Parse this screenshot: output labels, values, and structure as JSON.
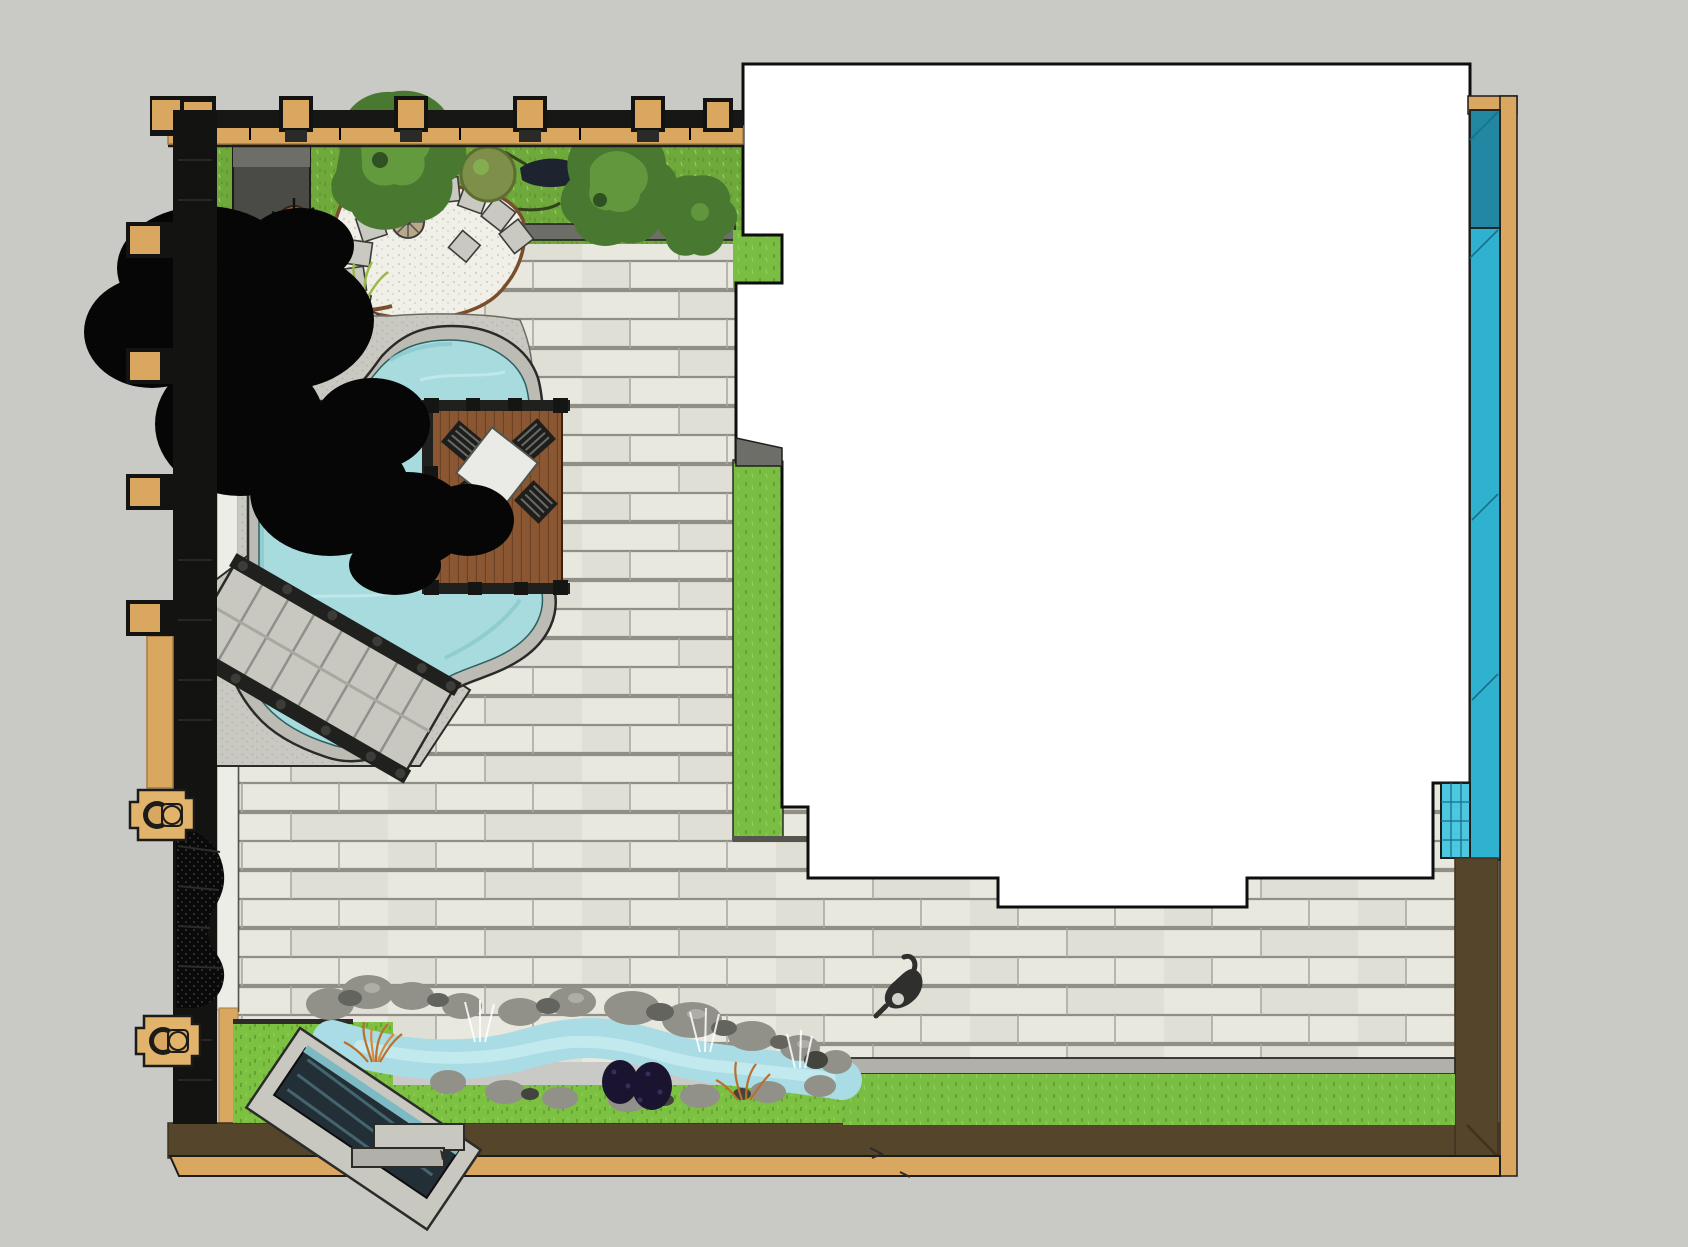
{
  "canvas": {
    "width": 1688,
    "height": 1247
  },
  "scene": {
    "type": "landscape-design-plan-top-view",
    "elements": [
      "house-footprint",
      "paver-patio",
      "kidney-pool",
      "pool-coping",
      "wood-deck",
      "patio-table",
      "patio-chairs",
      "spa-stairs",
      "garden-lawn",
      "gravel-garden",
      "stepping-stones",
      "round-shrub",
      "potted-plants",
      "conifer-trees",
      "shade-tree-canopy",
      "water-wall-strip",
      "tile-spa-block",
      "stream-water-feature",
      "waterfall-spillway",
      "stream-rocks",
      "fountain-jets",
      "ornamental-bushes",
      "perimeter-fence",
      "fence-posts",
      "hose-bib-boxes",
      "privacy-mesh",
      "soil-bed",
      "timber-border",
      "lawn-strips",
      "person-figure"
    ]
  },
  "palette": {
    "bg": "#c9c9c6",
    "paver": "#e9e8df",
    "paverAlt": "#e0dfd6",
    "paverLine": "#8f8f87",
    "paverLine2": "#aaaaa2",
    "curb": "#edede7",
    "lawnTop": "#6fa93c",
    "lawnBright": "#79bd42",
    "lawnBottom": "#7cc141",
    "grassDark": "#578f2b",
    "grassLight": "#8ed15a",
    "gravel": "#f1f0e8",
    "gravelDot": "#cfcec3",
    "pathGray": "#d4d4cc",
    "apron": "#c9c9c1",
    "apronDot": "#b2b2aa",
    "edgeBrown": "#7a4e2c",
    "coping": "#bcbcb4",
    "outline": "#1c1c1a",
    "pool": "#a7dbde",
    "poolLight": "#c6ebec",
    "poolDeep": "#86c8cc",
    "wood": "#8a5732",
    "woodLine": "#6b4223",
    "railDark": "#20201e",
    "tableWhite": "#eaeae6",
    "chairDark": "#1e1e1c",
    "stairs": "#c8c8c0",
    "stairsLine": "#90908a",
    "black": "#060606",
    "conifDark": "#2e5223",
    "conif": "#497930",
    "conifLight": "#6ca242",
    "shrubOlive": "#7d8f48",
    "oliveDark": "#5d6c33",
    "house": "#ffffff",
    "cyanDark": "#2187a3",
    "cyan": "#2eb2cf",
    "cyanLight": "#4cc7e0",
    "cyanLine": "#1a6f88",
    "tan": "#d9a75f",
    "tanDark": "#a87c41",
    "brownBed": "#55452a",
    "brownBedDark": "#3e3220",
    "edging": "#b1b1a9",
    "rock": "#91918a",
    "rockDark": "#64645e",
    "rockDarker": "#44443f",
    "rockLight": "#b5b5ad",
    "stream": "#a9dce4",
    "streamLight": "#cdeef2",
    "spillDark": "#232f37",
    "spillGlass": "#44656f",
    "orangeBush": "#b96f2e",
    "orangeBushLight": "#d98a3f",
    "purpleBush": "#1a1430",
    "mesh": "#0a0a0a",
    "person": "#2f2f2d",
    "personHead": "#d2d2cc",
    "wedgeGray": "#6e6e68",
    "shed": "#4a4a46",
    "shedTop": "#6e6e68"
  }
}
